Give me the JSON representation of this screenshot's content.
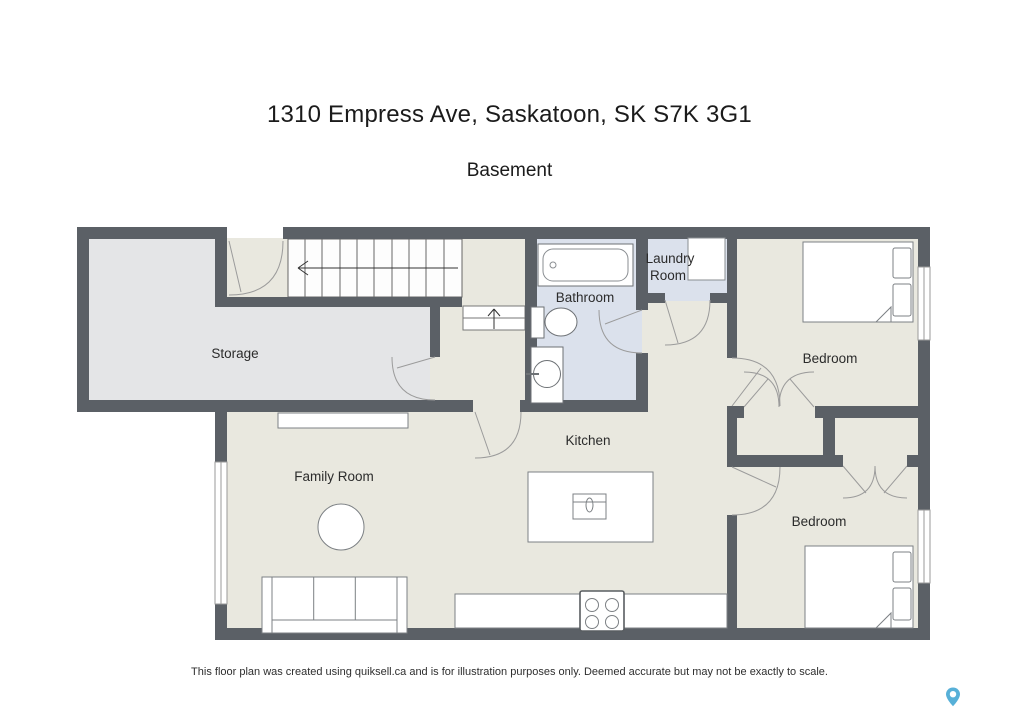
{
  "page": {
    "title": "1310 Empress Ave, Saskatoon, SK S7K 3G1",
    "subtitle": "Basement",
    "footer": "This floor plan was created using quiksell.ca and is for illustration purposes only. Deemed accurate but may not be exactly to scale."
  },
  "floor_plan": {
    "rooms": {
      "storage": "Storage",
      "bathroom": "Bathroom",
      "laundry_line1": "Laundry",
      "laundry_line2": "Room",
      "bedroom_top": "Bedroom",
      "bedroom_bottom": "Bedroom",
      "kitchen": "Kitchen",
      "family_room": "Family Room"
    },
    "fixtures": [
      "staircase",
      "stair-landing-up-arrow",
      "bathtub",
      "toilet",
      "bathroom-sink",
      "washer-dryer",
      "kitchen-island-sink",
      "stove",
      "kitchen-counter",
      "sofa",
      "round-table",
      "media-shelf",
      "bed-top",
      "bed-bottom",
      "closet-double-doors-top",
      "closet-double-doors-bottom",
      "windows"
    ],
    "colors": {
      "wall": "#5b6066",
      "floor_main": "#e9e8df",
      "floor_storage": "#e4e5e7",
      "floor_wet": "#dbe1ec",
      "fixture_fill": "#ffffff",
      "pin_accent": "#57b0d8"
    }
  }
}
